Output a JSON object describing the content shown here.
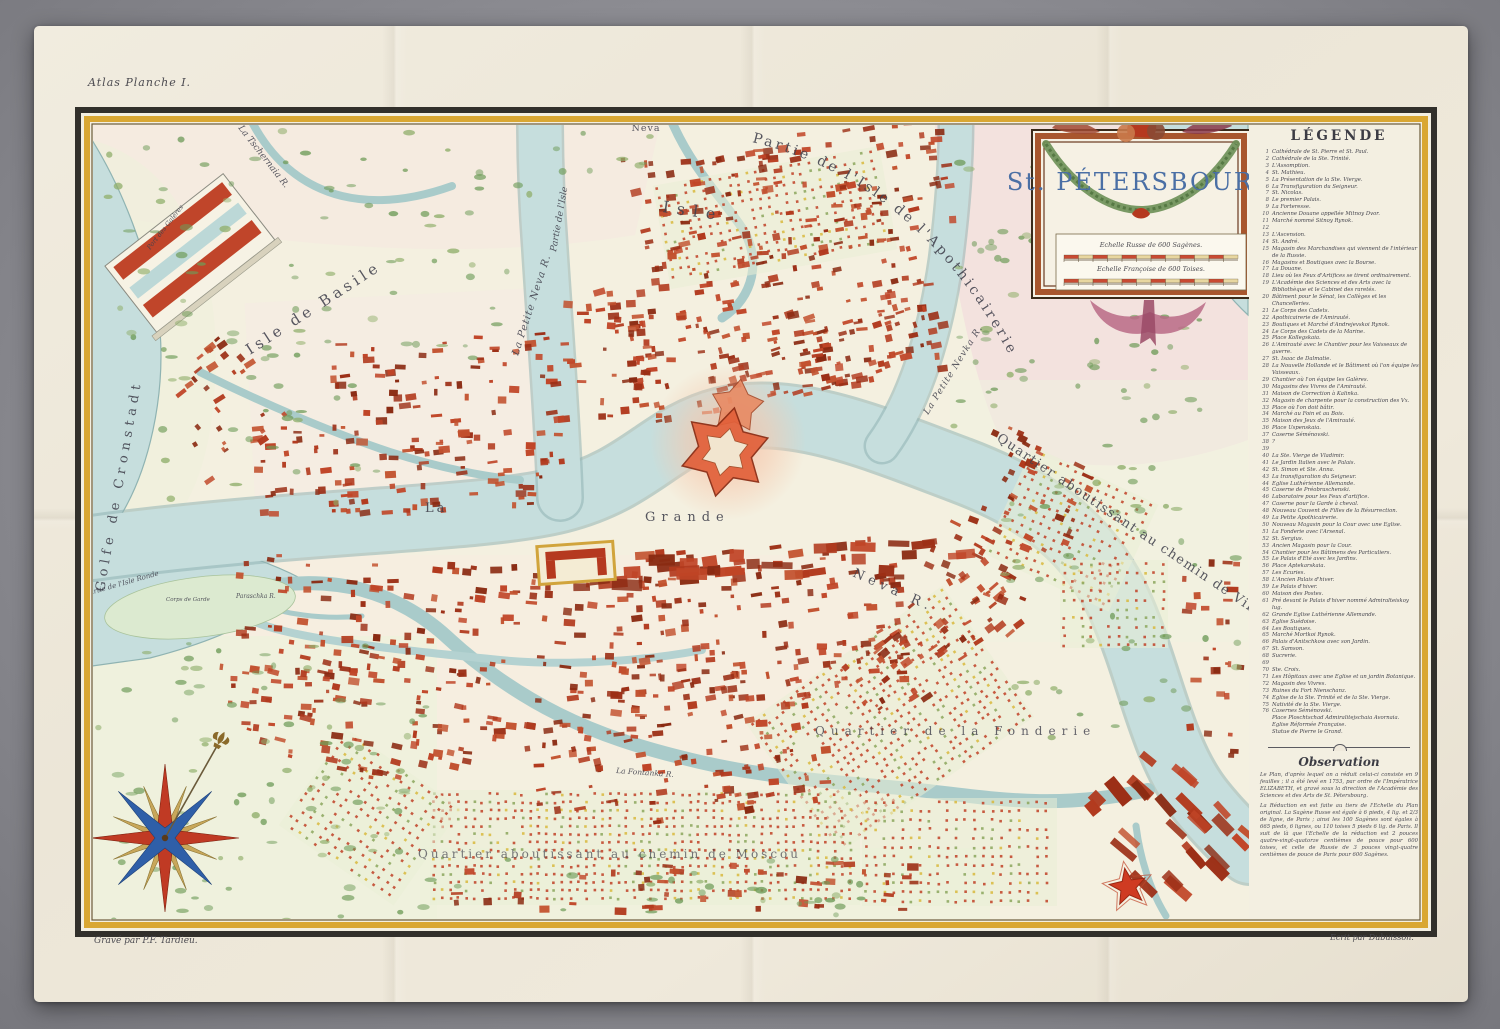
{
  "page": {
    "plate_note": "Atlas Planche I.",
    "engraver_credit": "Gravé par P.F. Tardieu.",
    "writer_credit": "Ecrit par Dubuisson."
  },
  "cartouche": {
    "title": "St. PÉTERSBOURG",
    "scale_russian": "Echelle Russe de 600 Sagènes.",
    "scale_french": "Echelle Françoise de 600 Toises."
  },
  "legend": {
    "title": "LÉGENDE",
    "items": [
      {
        "n": "1",
        "text": "Cathédrale de St. Pierre et St. Paul."
      },
      {
        "n": "2",
        "text": "Cathédrale de la Ste. Trinité."
      },
      {
        "n": "3",
        "text": "L'Assomption."
      },
      {
        "n": "4",
        "text": "St. Mathieu."
      },
      {
        "n": "5",
        "text": "La Présentation de la Ste. Vierge."
      },
      {
        "n": "6",
        "text": "La Transfiguration du Seigneur."
      },
      {
        "n": "7",
        "text": "St. Nicolas."
      },
      {
        "n": "8",
        "text": "Le premier Palais."
      },
      {
        "n": "9",
        "text": "La Forteresse."
      },
      {
        "n": "10",
        "text": "Ancienne Douane appellée Mitnoy Dvor."
      },
      {
        "n": "11",
        "text": "Marché nommé Sitnoy Rynok."
      },
      {
        "n": "12",
        "text": ""
      },
      {
        "n": "13",
        "text": "L'Ascension."
      },
      {
        "n": "14",
        "text": "St. André."
      },
      {
        "n": "15",
        "text": "Magasin des Marchandises qui viennent de l'intérieur de la Russie."
      },
      {
        "n": "16",
        "text": "Magasins et Boutiques avec la Bourse."
      },
      {
        "n": "17",
        "text": "La Douane."
      },
      {
        "n": "18",
        "text": "Lieu où les Feux d'Artifices se tirent ordinairement."
      },
      {
        "n": "19",
        "text": "L'Académie des Sciences et des Arts avec la Bibliothèque et le Cabinet des raretés."
      },
      {
        "n": "20",
        "text": "Bâtiment pour le Sénat, les Collèges et les Chancelleries."
      },
      {
        "n": "21",
        "text": "Le Corps des Cadets."
      },
      {
        "n": "22",
        "text": "Apothicairerie de l'Amirauté."
      },
      {
        "n": "23",
        "text": "Boutiques et Marché d'Andrejevskoi Rynok."
      },
      {
        "n": "24",
        "text": "Le Corps des Cadets de la Marine."
      },
      {
        "n": "25",
        "text": "Place Kollegskaia."
      },
      {
        "n": "26",
        "text": "L'Amirauté avec le Chantier pour les Vaisseaux de guerre."
      },
      {
        "n": "27",
        "text": "St. Isaac de Dalmatie."
      },
      {
        "n": "28",
        "text": "La Nouvelle Hollande et le Bâtiment où l'on équipe les Vaisseaux."
      },
      {
        "n": "29",
        "text": "Chantier où l'on équipe les Galères."
      },
      {
        "n": "30",
        "text": "Magasins des Vivres de l'Amirauté."
      },
      {
        "n": "31",
        "text": "Maison de Correction à Kalinka."
      },
      {
        "n": "32",
        "text": "Magasin de charpente pour la construction des Vx."
      },
      {
        "n": "33",
        "text": "Place où l'on doit bâtir."
      },
      {
        "n": "34",
        "text": "Marché au Foin et au Bois."
      },
      {
        "n": "35",
        "text": "Maison des Jeux de l'Amirauté."
      },
      {
        "n": "36",
        "text": "Place Uspenskaia."
      },
      {
        "n": "37",
        "text": "Caserne Séménovski."
      },
      {
        "n": "38",
        "text": "?"
      },
      {
        "n": "39",
        "text": ""
      },
      {
        "n": "40",
        "text": "La Ste. Vierge de Vladimir."
      },
      {
        "n": "41",
        "text": "Le Jardin Italien avec le Palais."
      },
      {
        "n": "42",
        "text": "St. Simon et Ste. Anna."
      },
      {
        "n": "43",
        "text": "La transfiguration du Seigneur."
      },
      {
        "n": "44",
        "text": "Eglise Luthérienne Allemande."
      },
      {
        "n": "45",
        "text": "Caserne de Préobraschenski."
      },
      {
        "n": "46",
        "text": "Laboratoire pour les Feux d'artifice."
      },
      {
        "n": "47",
        "text": "Caserne pour la Garde à cheval."
      },
      {
        "n": "48",
        "text": "Nouveau Couvent de Filles de la Résurrection."
      },
      {
        "n": "49",
        "text": "La Petite Apothicairerie."
      },
      {
        "n": "50",
        "text": "Nouveau Magasin pour la Cour avec une Eglise."
      },
      {
        "n": "51",
        "text": "La Fonderie avec l'Arsenal."
      },
      {
        "n": "52",
        "text": "St. Sergius."
      },
      {
        "n": "53",
        "text": "Ancien Magasin pour la Cour."
      },
      {
        "n": "54",
        "text": "Chantier pour les Bâtimens des Particuliers."
      },
      {
        "n": "55",
        "text": "Le Palais d'Eté avec les Jardins."
      },
      {
        "n": "56",
        "text": "Place Aptekarskaia."
      },
      {
        "n": "57",
        "text": "Les Ecuries."
      },
      {
        "n": "58",
        "text": "L'Ancien Palais d'hiver."
      },
      {
        "n": "59",
        "text": "Le Palais d'hiver."
      },
      {
        "n": "60",
        "text": "Maison des Postes."
      },
      {
        "n": "61",
        "text": "Pré devant le Palais d'hiver nommé Admiralteiskoy lug."
      },
      {
        "n": "62",
        "text": "Grande Eglise Luthérienne Allemande."
      },
      {
        "n": "63",
        "text": "Eglise Suédoise."
      },
      {
        "n": "64",
        "text": "Les Boutiques."
      },
      {
        "n": "65",
        "text": "Marché Mortkoi Rynok."
      },
      {
        "n": "66",
        "text": "Palais d'Anitschkow avec son Jardin."
      },
      {
        "n": "67",
        "text": "St. Samson."
      },
      {
        "n": "68",
        "text": "Sucrerie."
      },
      {
        "n": "69",
        "text": ""
      },
      {
        "n": "70",
        "text": "Ste. Croix."
      },
      {
        "n": "71",
        "text": "Les Hôpitaux avec une Eglise et un jardin Botanique."
      },
      {
        "n": "72",
        "text": "Magasin des Vivres."
      },
      {
        "n": "73",
        "text": "Ruines du Fort Nienschanz."
      },
      {
        "n": "74",
        "text": "Eglise de la Ste. Trinité et de la Ste. Vierge."
      },
      {
        "n": "75",
        "text": "Nativité de la Ste. Vierge."
      },
      {
        "n": "76",
        "text": "Casernes Séménovski."
      },
      {
        "n": "",
        "text": "Place Ploschtschad Admiralitejschaia Avornaia."
      },
      {
        "n": "",
        "text": "Eglise Réformée Française."
      },
      {
        "n": "",
        "text": "Statue de Pierre le Grand."
      }
    ]
  },
  "observation": {
    "title": "Observation",
    "paragraphs": [
      "Le Plan, d'après lequel on a réduit celui-ci consiste en 9 feuilles ; il a été levé en 1753, par ordre de l'Impératrice ELIZABETH, et gravé sous la direction de l'Académie des Sciences et des Arts de St. Pétersbourg.",
      "La Réduction en est faite au tiers de l'Echelle du Plan original. La Sagène Russe est égale à 6 pieds, 4 lig. et 2/3 de ligne, de Paris ; ainsi les 100 Sagènes sont égales à 665 pieds, 6 lignes, ou 110 toises 5 pieds 6 lig. de Paris. Il suit de là que l'Echelle de la réduction est 2 pouces quatre-vingt-quatorze centièmes de pouce pour 600 toises, et celle de Russie de 3 pouces vingt-quatre centièmes de pouce de Paris pour 600 Sagènes."
    ]
  },
  "map_labels": {
    "gulf_upper": "Golfe de Cronstadt",
    "gulf_lower": "Golfe de Cronstadt",
    "isle_basile": "Isle de Basile",
    "isle": "Isle",
    "pnp1": "Partie de la Petite",
    "pnp2": "Neva",
    "apoth": "Partie de l'Isle de l'Apothicairerie",
    "isle_part": "Partie de l'Isle",
    "petite_neva": "La Petite Neva R.",
    "petite_nevka": "La Petite Nevka R.",
    "tschernaia": "La Tschernaia R.",
    "la": "La",
    "grande": "Grande",
    "neva_r": "Neva R.",
    "vibourg": "Quartier aboutissant au chemin de Vibourg.",
    "fonderie": "Quartier de la Fonderie",
    "moscou": "Quartier aboutissant au chemin de Moscou",
    "isle_ronde": "Partie de l'Isle Ronde",
    "corps_garde": "Corps de Garde",
    "paraschka": "Paraschka R.",
    "fontanka": "La Fontanka R.",
    "port_galeres": "Port des Galères"
  },
  "colors": {
    "brick": "#b5391f",
    "water": "#c3dcda",
    "water_edge": "#8fb3b2",
    "gold_frame": "#d9a733",
    "title_blue": "#4a6fa5",
    "pink_wash": "#f3dede",
    "meadow": "#eef2dc",
    "rose_red": "#c03a24",
    "rose_blue": "#2f5fa8",
    "rose_gold": "#c8a75a"
  }
}
